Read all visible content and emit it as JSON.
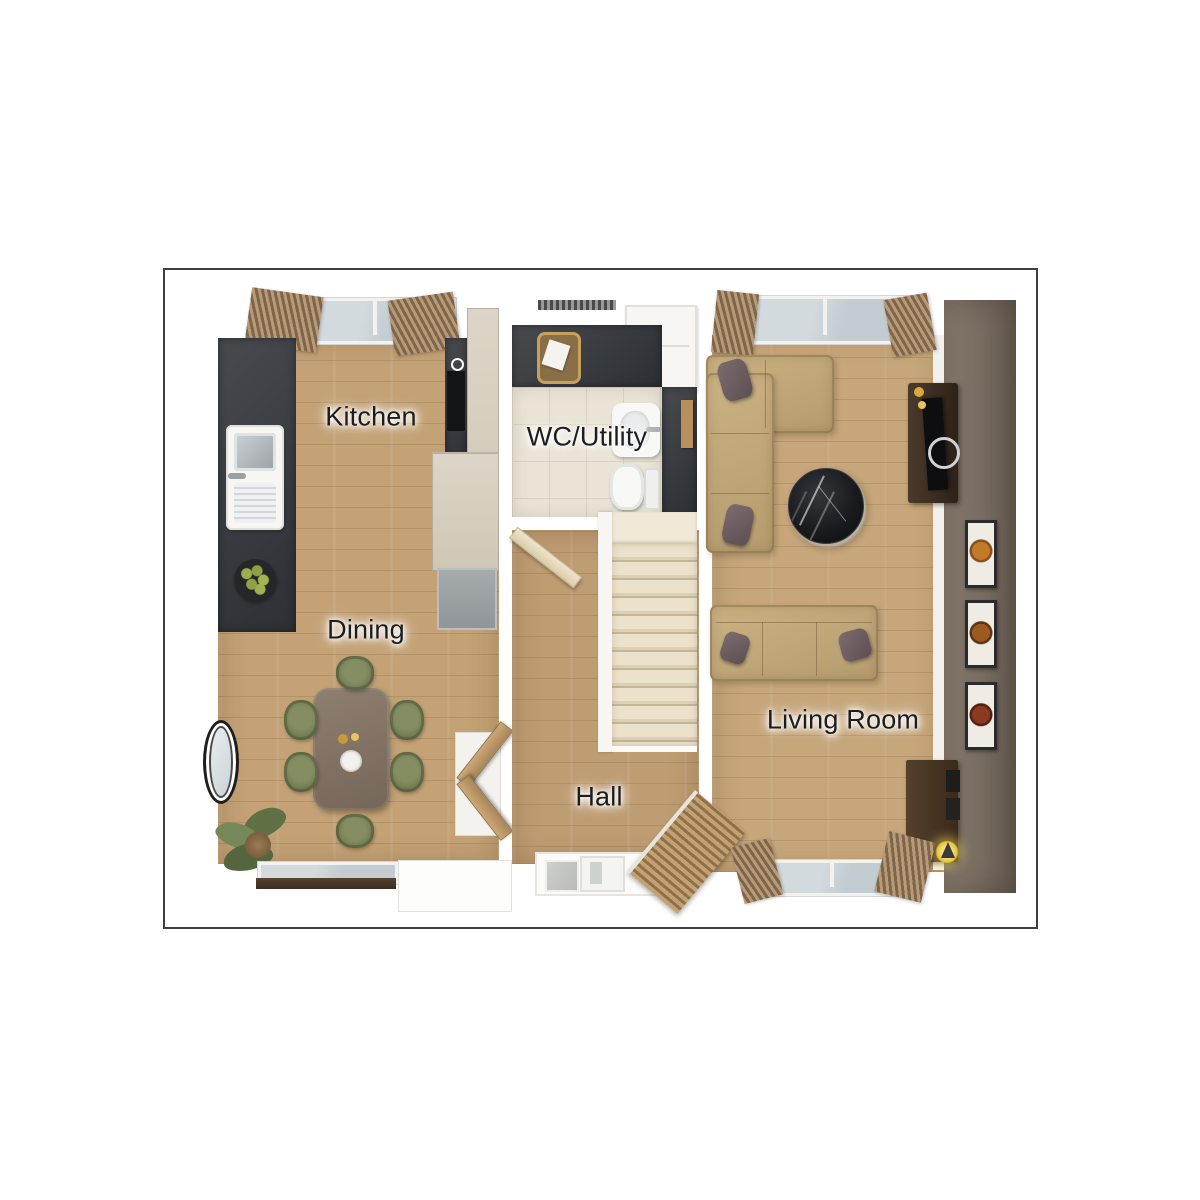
{
  "plan": {
    "kind": "3d-floor-plan-render"
  },
  "labels": {
    "kitchen": "Kitchen",
    "wc_utility": "WC/Utility",
    "dining": "Dining",
    "hall": "Hall",
    "living_room": "Living Room"
  },
  "palette": {
    "frame_border": "#3e3e42",
    "background": "#ffffff",
    "kitchen_dining_floor": "#c4a276",
    "hall_floor": "#bf9d73",
    "living_floor": "#c6a67a",
    "wc_tile_floor": "#eae4d6",
    "dark_worktop": "#3a3d41",
    "accent_wall": "#75695d",
    "sofa_fabric": "#c3aa7b",
    "scatter_cushion": "#6f5e62",
    "dining_chair_green": "#76805a",
    "dining_table_wood": "#85766a",
    "stairs_carpet": "#e9e0cd",
    "coffee_table_marble": "#1a1b1e",
    "media_unit_wood": "#3b2c20",
    "curtain": "#a3876a",
    "window_glass": "#c9d1d5",
    "lamp_glow": "#e4c23a",
    "plant_green": "#6b7a4f"
  },
  "furniture": {
    "kitchen": [
      "worktop-run",
      "sink",
      "hob",
      "tall-cabinets",
      "fridge",
      "fruit-bowl"
    ],
    "dining": [
      "dining-table",
      "six-chairs",
      "wall-mirror",
      "palm-plant",
      "french-doors",
      "window"
    ],
    "wc_utility": [
      "worktop",
      "laundry-basket",
      "washing-machine",
      "basin",
      "toilet",
      "shelf"
    ],
    "hall": [
      "staircase",
      "front-door",
      "internal-door"
    ],
    "living_room": [
      "corner-sofa",
      "three-seat-sofa",
      "round-coffee-table",
      "tv-media-unit",
      "sideboard",
      "table-lamp",
      "wall-art-frames",
      "louvre-door",
      "windows"
    ]
  }
}
